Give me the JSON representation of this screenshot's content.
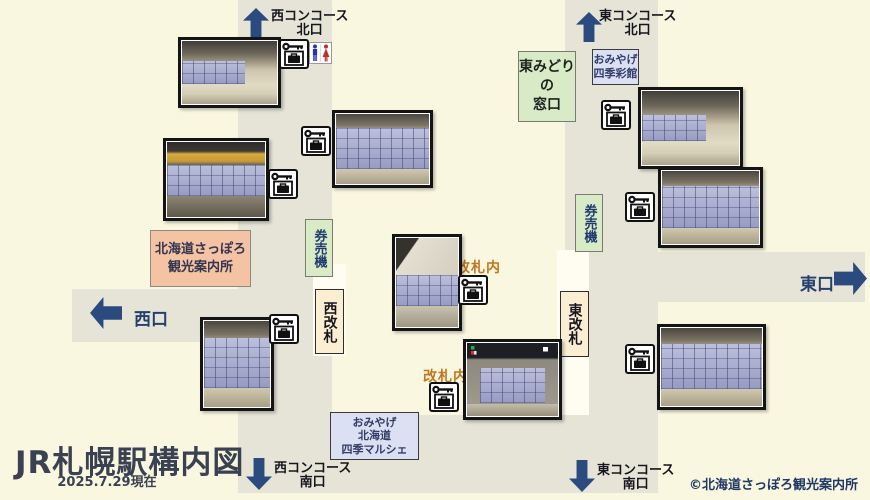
{
  "app": {
    "title": "JR札幌駅構内図",
    "as_of": "2025.7.29現在",
    "copyright": "©北海道さっぽろ観光案内所"
  },
  "colors": {
    "background": "#FAF7E1",
    "corridor": "#E5E4D7",
    "arrow_navy": "#2B4B7E",
    "green_box": "#D9EAC7",
    "lavender_box": "#DBE0F3",
    "cream_box": "#FBEED3",
    "salmon_box": "#F4C3A3",
    "inside_gate_text": "#C0761E",
    "title_text": "#3A4150"
  },
  "exits": {
    "west_north": {
      "line1": "西コンコース",
      "line2": "北口"
    },
    "east_north": {
      "line1": "東コンコース",
      "line2": "北口"
    },
    "west_south": {
      "line1": "西コンコース",
      "line2": "南口"
    },
    "east_south": {
      "line1": "東コンコース",
      "line2": "南口"
    },
    "west": {
      "label": "西口"
    },
    "east": {
      "label": "東口"
    }
  },
  "facilities": {
    "midori_madoguchi": {
      "line1": "東みどりの",
      "line2": "窓口"
    },
    "shikisaikan": {
      "line1": "おみやげ",
      "line2": "四季彩館"
    },
    "ticket_machine_west": {
      "label": "券売機"
    },
    "ticket_machine_east": {
      "label": "券売機"
    },
    "west_gate": {
      "label": "西改札"
    },
    "east_gate": {
      "label": "東改札"
    },
    "tourist_info": {
      "line1": "北海道さっぽろ",
      "line2": "観光案内所"
    },
    "marche": {
      "line1": "おみやげ",
      "line2": "北海道",
      "line3": "四季マルシェ"
    },
    "inside_gate_label_top": "改札内",
    "inside_gate_label_bottom": "改札内"
  },
  "icons": {
    "locker_key_icon": "coin-locker-location",
    "restroom_icon": "restroom"
  }
}
